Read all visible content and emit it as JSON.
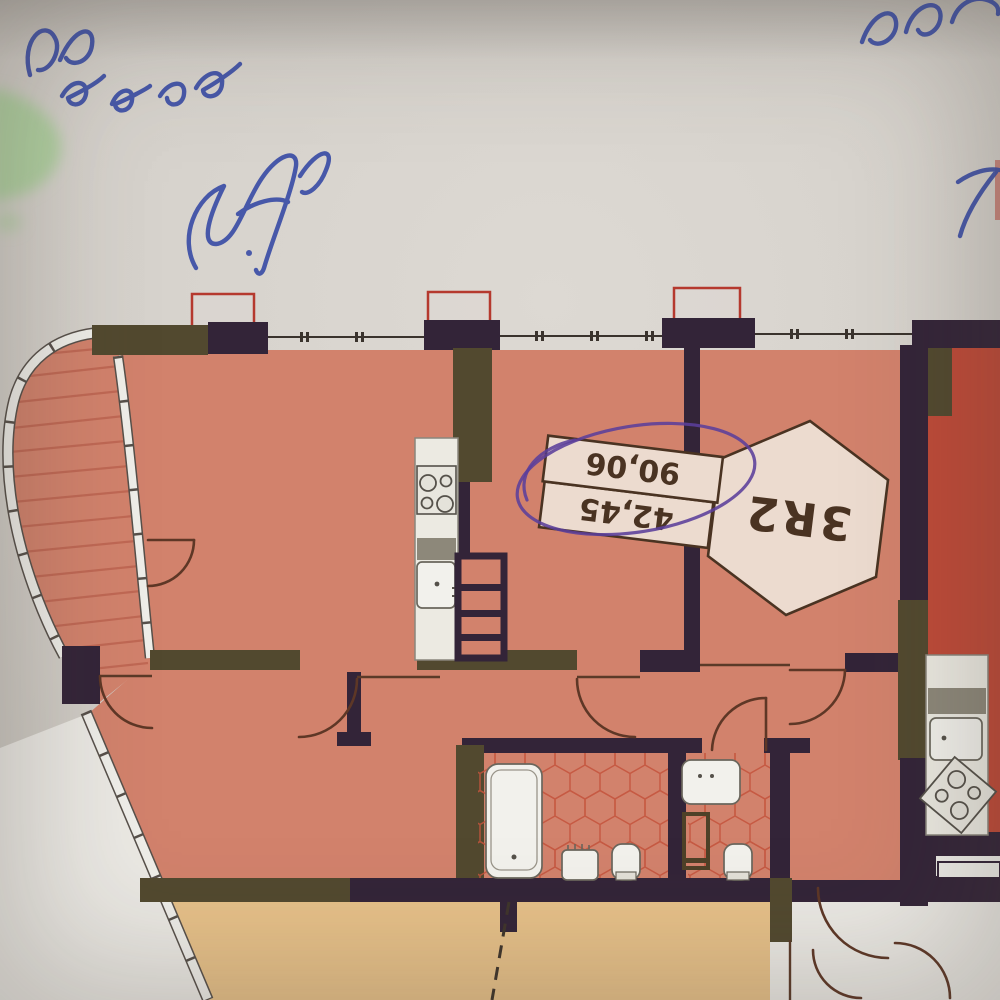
{
  "annotations": {
    "handwriting_ink_color": "#3b4da6",
    "highlighter_color": "#a8cf97",
    "pen_circle_color": "#5b3f9b"
  },
  "plan": {
    "unit_label": {
      "code": "3R2",
      "area_rows": [
        "42,45",
        "90,06"
      ],
      "circled_value": "90,06"
    },
    "colors": {
      "paper": "#d7d3cd",
      "paper_margin": "#ebe9e4",
      "wall": "#332438",
      "wall_accent": "#52492f",
      "unit_floor": "#d2826c",
      "balcony_stripe": "#bd6450",
      "adjacent_unit_floor": "#bf4a38",
      "lower_unit_floor": "#e7c189",
      "corridor_floor": "#eceae5",
      "fixture_fill": "#f2f1ec",
      "tile_outline": "#c4533c",
      "railing_outline": "#b5392e"
    }
  }
}
